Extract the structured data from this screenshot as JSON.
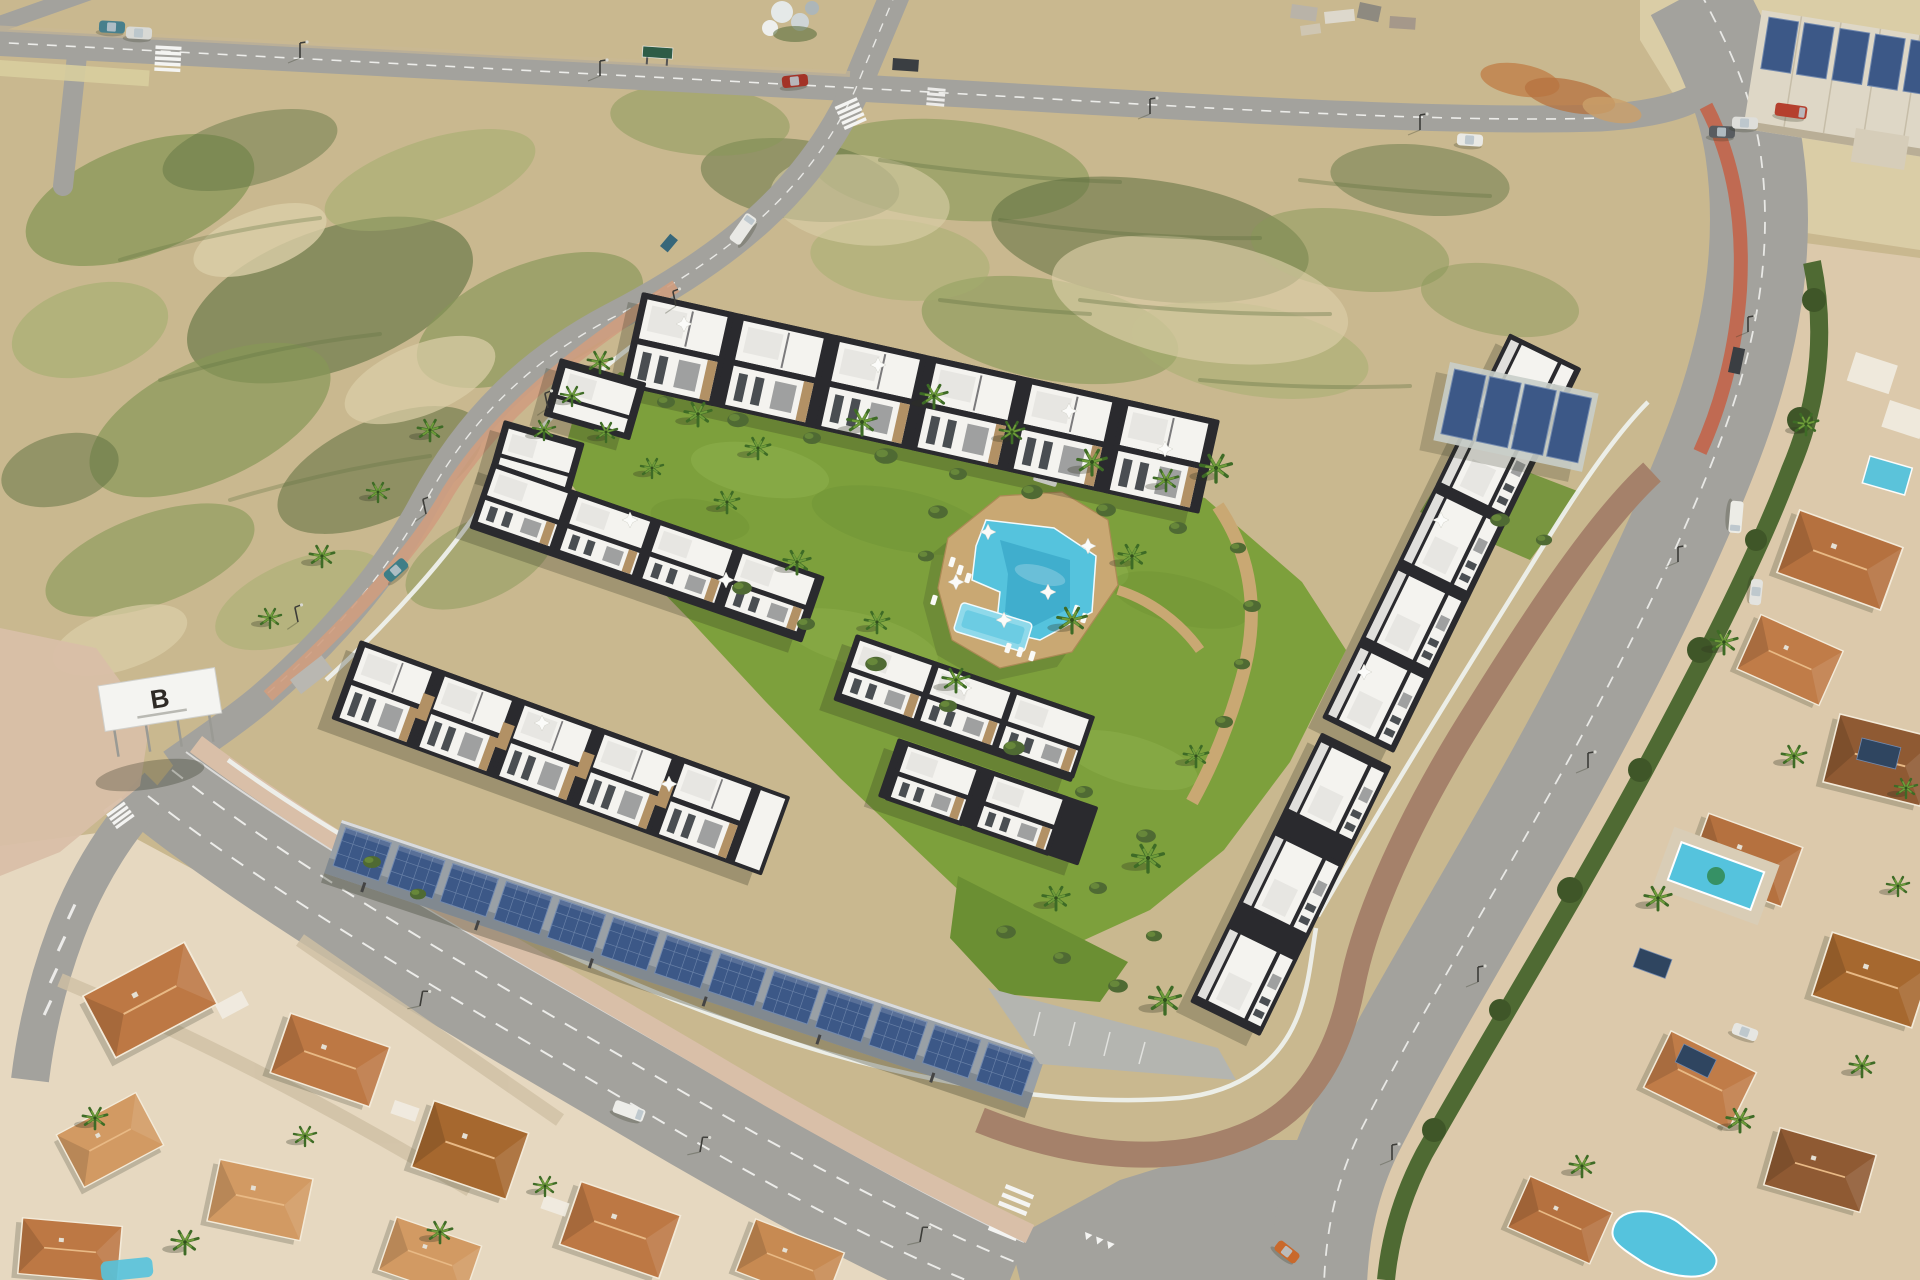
{
  "meta": {
    "title": "Aerial 3D render of a new-build residential complex with communal pool, solar carports and surrounding streets",
    "type": "aerial-photograph"
  },
  "billboard": {
    "letter": "B"
  },
  "colors": {
    "sand": "#c9b88f",
    "sand-light": "#dbcea8",
    "scrub": "#879757",
    "scrub-dark": "#5e7040",
    "scrub-light": "#a3ad6e",
    "asphalt": "#a3a29d",
    "asphalt-light": "#b9b7b1",
    "line": "#f4f4f2",
    "lawn": "#7da03c",
    "lawn-light": "#90b24e",
    "lawn-dark": "#6b8f33",
    "deck": "#c9a873",
    "deck-dark": "#ab8a55",
    "pool": "#55c3dd",
    "pool-deep": "#2f9dbf",
    "pool-light": "#8fd9ea",
    "white-bld": "#f4f3ef",
    "roof-dark": "#2a2a2e",
    "glass": "#4a4e52",
    "terrace": "#e7e6e2",
    "stone": "#b29165",
    "solar": "#3c5887",
    "solar-light": "#7289ae",
    "terracotta": "#bd7844",
    "pink": "#d9bfa8",
    "brown-walk": "#a5816a",
    "bike": "#c06a52",
    "hedge": "#4f6a33",
    "wall": "#eef0ec",
    "shadow": "#2e3320",
    "cream": "#e6d8c0",
    "cream-e": "#dcc9ab"
  }
}
